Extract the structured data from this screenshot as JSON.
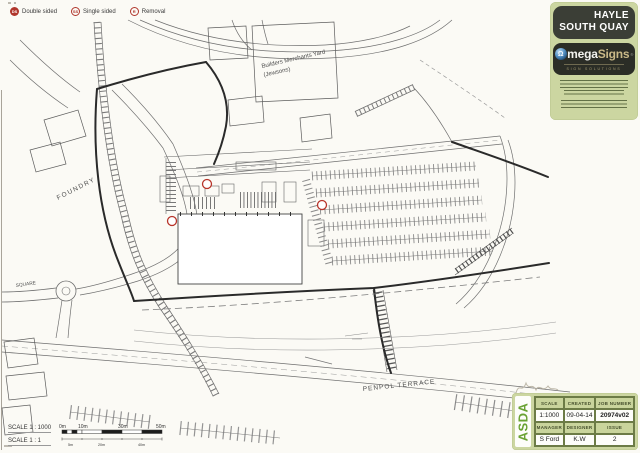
{
  "page": {
    "background": "#fbfaf5"
  },
  "legend": {
    "accent_color": "#b0362c",
    "items": [
      {
        "symbol": "DS",
        "label": "Double sided"
      },
      {
        "symbol": "SS",
        "label": "Single sided"
      },
      {
        "symbol": "R",
        "label": "Removal"
      }
    ]
  },
  "header": {
    "title_line1": "HAYLE",
    "title_line2": "SOUTH QUAY",
    "logo": {
      "omega_symbol": "Ω",
      "part1": "mega",
      "part2": "Signs",
      "reg": "®",
      "tagline": "SIGN SOLUTIONS"
    }
  },
  "map": {
    "marker_color": "#b8342a",
    "labels": {
      "builders_yard_line1": "Builders Merchants Yard",
      "builders_yard_line2": "(Jewsons)",
      "foundry": "FOUNDRY",
      "square": "SQUARE",
      "penpol_terrace": "PENPOL TERRACE"
    }
  },
  "scalebar": {
    "line1": "SCALE 1 : 1000",
    "line2": "SCALE 1 : 1",
    "top_labels": [
      "0m",
      "10m",
      "30m",
      "50m"
    ],
    "bottom_labels": [
      "5m",
      "20m",
      "40m"
    ]
  },
  "titleblock": {
    "brand": "ASDA",
    "scale_label": "SCALE",
    "created_label": "CREATED",
    "job_label": "JOB NUMBER",
    "scale_value": "1:1000",
    "created_value": "09-04-14",
    "job_value": "20974v02",
    "manager_label": "MANAGER",
    "designer_label": "DESIGNER",
    "issue_label": "ISSUE",
    "manager_value": "S Ford",
    "designer_value": "K.W",
    "issue_value": "2"
  }
}
